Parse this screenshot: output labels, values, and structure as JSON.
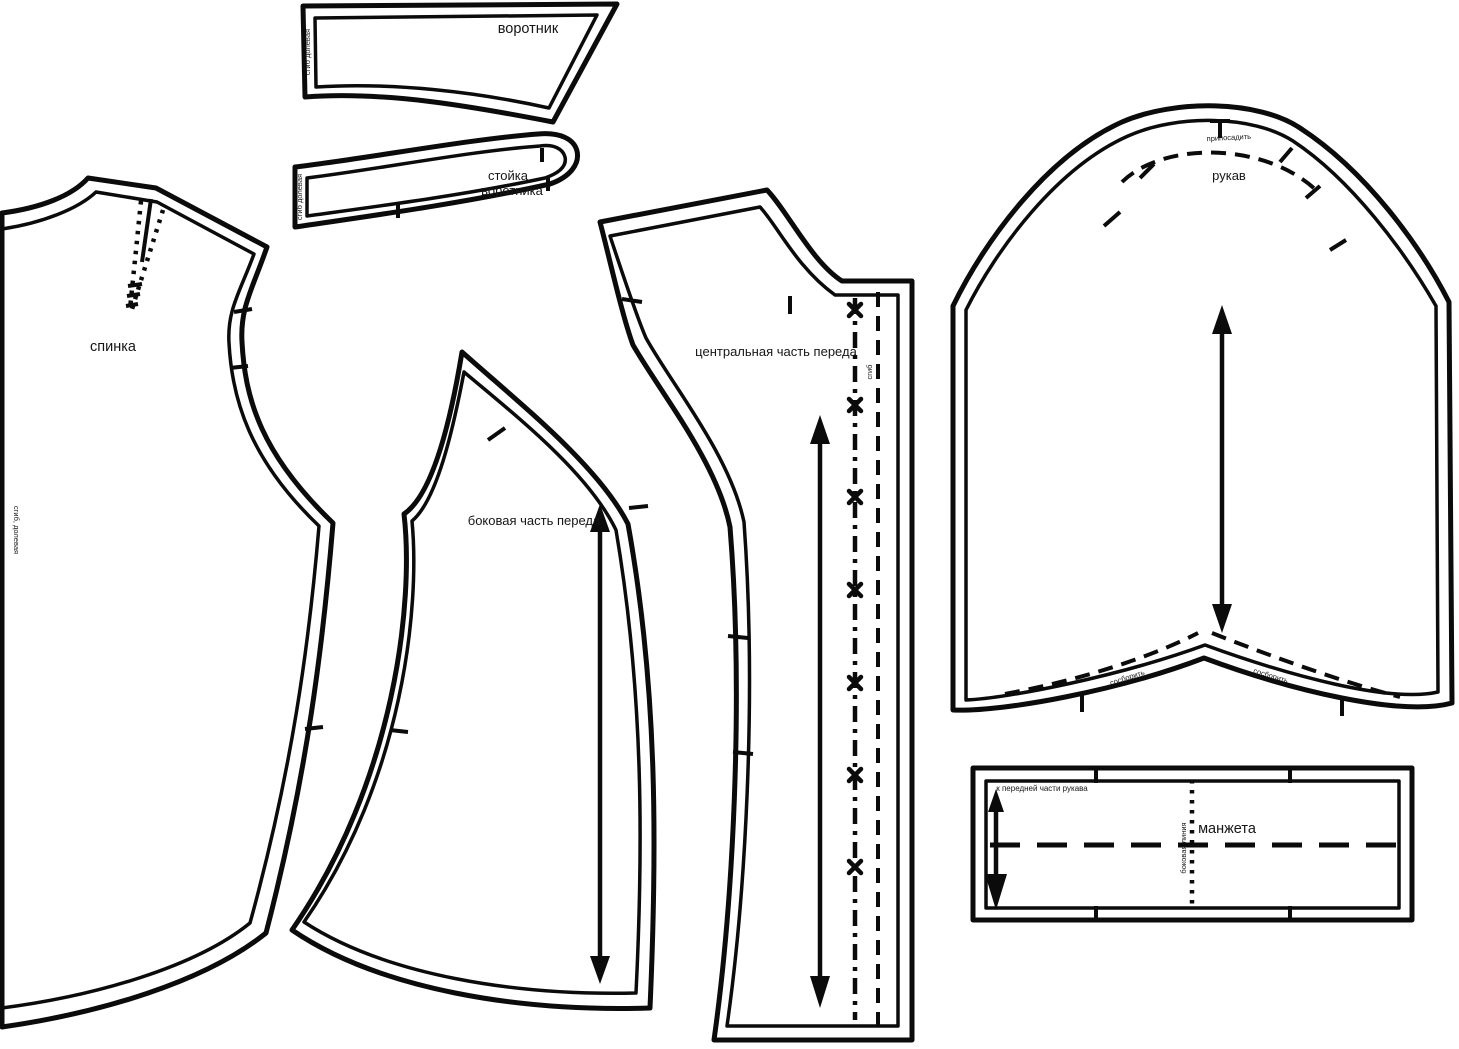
{
  "pieces": {
    "collar": {
      "label": "воротник",
      "fold_text": "сгиб долевая"
    },
    "collar_stand": {
      "label_line1": "стойка",
      "label_line2": "воротника",
      "fold_text": "сгиб долевая"
    },
    "back": {
      "label": "спинка",
      "fold_text": "сгиб, долевая"
    },
    "side_front": {
      "label": "боковая часть переда"
    },
    "center_front": {
      "label": "центральная часть переда",
      "fold_text": "сгиб"
    },
    "sleeve": {
      "label": "рукав",
      "ease_text": "припосадить",
      "gather_text_left": "сосборить",
      "gather_text_right": "сосборить"
    },
    "cuff": {
      "label": "манжета",
      "note": "к передней части рукава",
      "side_line_text": "боковая линия"
    }
  },
  "colors": {
    "line": "#0b0b0b",
    "background": "#ffffff"
  }
}
